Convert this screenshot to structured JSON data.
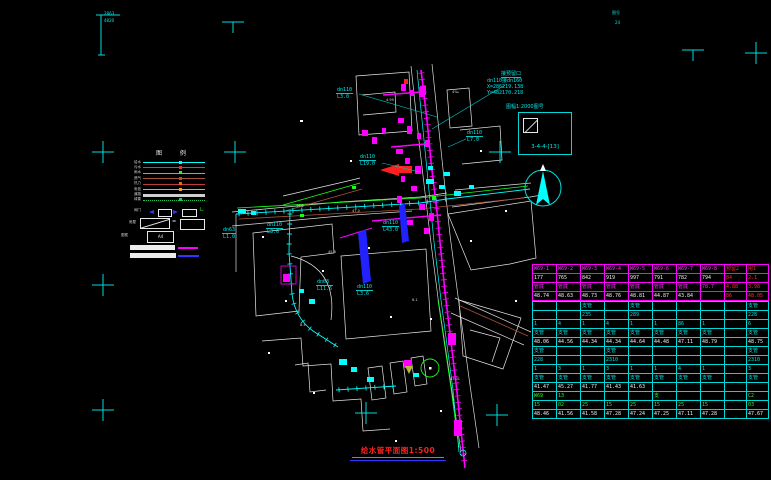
{
  "title": {
    "text": "给水管平面图1:500"
  },
  "corner": {
    "t1": "2863",
    "t2": "4820",
    "tr1": "图号",
    "tr2": "24"
  },
  "north_label": "北",
  "scale_box": {
    "title": "图幅1:2000图号",
    "code": "3-4-4-[13]"
  },
  "callout": {
    "l1": "接预留口",
    "l2": "dn110接dn160",
    "l3": "X=286219.138",
    "l4": "Y=482170.218"
  },
  "legend": {
    "header": "图 例",
    "lines": [
      {
        "label": "给水",
        "color": "#00ffff",
        "thick": 1.4,
        "marker": "#00ffff",
        "dotted": false
      },
      {
        "label": "污水",
        "color": "#ff2a2a",
        "thick": 1,
        "marker": "#ff2a2a",
        "dotted": false
      },
      {
        "label": "雨水",
        "color": "#19ff19",
        "thick": 1,
        "marker": "#19ff19",
        "dotted": false
      },
      {
        "label": "燃气",
        "color": "#a5533a",
        "thick": 1,
        "marker": "#a5533a",
        "dotted": false
      },
      {
        "label": "热力",
        "color": "#c03a3a",
        "thick": 1,
        "marker": "#ff6a00",
        "dotted": false
      },
      {
        "label": "电信",
        "color": "#ff9f1a",
        "thick": 1,
        "marker": "#ff9f1a",
        "dotted": false
      },
      {
        "label": "道路",
        "color": "#cfcfcf",
        "thick": 2.2,
        "marker": "",
        "dotted": false
      },
      {
        "label": "绿篱",
        "color": "#19cc55",
        "thick": 1,
        "marker": "#19cc55",
        "dotted": true
      }
    ],
    "symbols_label": "阀门",
    "boxes_label": "房屋",
    "eq": "=",
    "frame_label": "图框",
    "frame_text": "A4"
  },
  "reg_marks": {
    "crosses": [
      [
        103,
        152
      ],
      [
        235,
        152
      ],
      [
        500,
        152
      ],
      [
        103,
        285
      ],
      [
        103,
        410
      ],
      [
        366,
        413
      ],
      [
        497,
        415
      ],
      [
        756,
        53
      ]
    ],
    "tees": [
      [
        233,
        22
      ],
      [
        693,
        50
      ]
    ]
  },
  "pipe_labels": [
    {
      "t1": "dn110",
      "t2": "L3.0",
      "x": 336,
      "y": 87,
      "leader": [
        359,
        94,
        437,
        117
      ]
    },
    {
      "t1": "dn110",
      "t2": "L7.0",
      "x": 466,
      "y": 130,
      "leader": [
        466,
        139,
        448,
        147
      ]
    },
    {
      "t1": "dn110",
      "t2": "L19.0",
      "x": 359,
      "y": 154,
      "leader": [
        382,
        163,
        420,
        172
      ]
    },
    {
      "t1": "dn110",
      "t2": "L3.6",
      "x": 266,
      "y": 222,
      "leader": null
    },
    {
      "t1": "dn110",
      "t2": "L43.0",
      "x": 382,
      "y": 220,
      "leader": null
    },
    {
      "t1": "dn63",
      "t2": "L11.6",
      "x": 316,
      "y": 279,
      "leader": null
    },
    {
      "t1": "dn110",
      "t2": "L3.6",
      "x": 356,
      "y": 284,
      "leader": null
    },
    {
      "t1": "dn63",
      "t2": "L1.0",
      "x": 222,
      "y": 227,
      "leader": null
    }
  ],
  "map_texts": [
    {
      "t": "4‰",
      "x": 452,
      "y": 90
    },
    {
      "t": "4.99",
      "x": 386,
      "y": 98
    },
    {
      "t": "43.01",
      "x": 450,
      "y": 377
    },
    {
      "t": "46.2",
      "x": 296,
      "y": 204
    },
    {
      "t": "45.8",
      "x": 328,
      "y": 250
    },
    {
      "t": "47.0",
      "x": 352,
      "y": 209
    },
    {
      "t": "8.4",
      "x": 300,
      "y": 323
    },
    {
      "t": "6.1",
      "x": 412,
      "y": 298
    }
  ],
  "table": {
    "x": 532,
    "y": 264,
    "col_widths": [
      24,
      24,
      24,
      24,
      24,
      24,
      24,
      24,
      22,
      22
    ],
    "sections": [
      {
        "border": "#ff00ff",
        "rows": [
          {
            "cells": [
              [
                "W69-1",
                "m"
              ],
              [
                "W69-2",
                "m"
              ],
              [
                "W69-3",
                "m"
              ],
              [
                "W69-4",
                "m"
              ],
              [
                "W69-5",
                "m"
              ],
              [
                "W69-6",
                "m"
              ],
              [
                "W69-7",
                "m"
              ],
              [
                "W69-8",
                "m"
              ],
              [
                "预留2",
                "r"
              ],
              [
                "甩1",
                "r"
              ]
            ]
          },
          {
            "cells": [
              [
                "177",
                "w"
              ],
              [
                "765",
                "w"
              ],
              [
                "842",
                "w"
              ],
              [
                "919",
                "w"
              ],
              [
                "997",
                "w"
              ],
              [
                "791",
                "w"
              ],
              [
                "782",
                "w"
              ],
              [
                "794",
                "w"
              ],
              [
                "84",
                "r"
              ],
              [
                "2.1",
                "r"
              ]
            ]
          },
          {
            "cells": [
              [
                "管底",
                "m"
              ],
              [
                "管底",
                "m"
              ],
              [
                "管底",
                "m"
              ],
              [
                "管底",
                "m"
              ],
              [
                "管底",
                "m"
              ],
              [
                "管底",
                "m"
              ],
              [
                "管底",
                "m"
              ],
              [
                "78.7",
                "m"
              ],
              [
                "4.88",
                "r"
              ],
              [
                "3.98",
                "r"
              ]
            ]
          },
          {
            "cells": [
              [
                "48.74",
                "w"
              ],
              [
                "48.63",
                "w"
              ],
              [
                "48.73",
                "w"
              ],
              [
                "48.76",
                "w"
              ],
              [
                "48.81",
                "w"
              ],
              [
                "44.87",
                "w"
              ],
              [
                "43.84",
                "w"
              ],
              [
                "",
                "w"
              ],
              [
                "86",
                "r"
              ],
              [
                "48.05",
                "r"
              ]
            ]
          }
        ]
      },
      {
        "border": "#00d8d8",
        "rows": [
          {
            "cells": [
              [
                "",
                "c"
              ],
              [
                "",
                "c"
              ],
              [
                "支管",
                "c"
              ],
              [
                "",
                "c"
              ],
              [
                "支管",
                "c"
              ],
              [
                "",
                "c"
              ],
              [
                "",
                "c"
              ],
              [
                "",
                "c"
              ],
              [
                "",
                "c"
              ],
              [
                "支管",
                "c"
              ]
            ]
          },
          {
            "cells": [
              [
                "",
                "c"
              ],
              [
                "",
                "c"
              ],
              [
                "235",
                "c"
              ],
              [
                "",
                "c"
              ],
              [
                "289",
                "c"
              ],
              [
                "",
                "c"
              ],
              [
                "",
                "c"
              ],
              [
                "",
                "c"
              ],
              [
                "",
                "c"
              ],
              [
                "228",
                "c"
              ]
            ]
          },
          {
            "cells": [
              [
                "1",
                "c"
              ],
              [
                "4",
                "c"
              ],
              [
                "1",
                "c"
              ],
              [
                "4",
                "c"
              ],
              [
                "1",
                "c"
              ],
              [
                "1",
                "c"
              ],
              [
                "86",
                "c"
              ],
              [
                "1",
                "c"
              ],
              [
                "",
                "c"
              ],
              [
                "6",
                "c"
              ]
            ]
          },
          {
            "cells": [
              [
                "支管",
                "c"
              ],
              [
                "支管",
                "c"
              ],
              [
                "支管",
                "c"
              ],
              [
                "支管",
                "c"
              ],
              [
                "支管",
                "c"
              ],
              [
                "支管",
                "c"
              ],
              [
                "支管",
                "c"
              ],
              [
                "支管",
                "c"
              ],
              [
                "",
                "c"
              ],
              [
                "支管",
                "c"
              ]
            ]
          },
          {
            "cells": [
              [
                "48.06",
                "w"
              ],
              [
                "44.56",
                "w"
              ],
              [
                "44.34",
                "w"
              ],
              [
                "44.34",
                "w"
              ],
              [
                "44.64",
                "w"
              ],
              [
                "44.48",
                "w"
              ],
              [
                "47.11",
                "w"
              ],
              [
                "48.79",
                "w"
              ],
              [
                "",
                "w"
              ],
              [
                "48.75",
                "w"
              ]
            ]
          },
          {
            "cells": [
              [
                "支管",
                "c"
              ],
              [
                "",
                "c"
              ],
              [
                "",
                "c"
              ],
              [
                "支管",
                "c"
              ],
              [
                "",
                "c"
              ],
              [
                "",
                "c"
              ],
              [
                "",
                "c"
              ],
              [
                "",
                "c"
              ],
              [
                "",
                "c"
              ],
              [
                "支管",
                "c"
              ]
            ]
          },
          {
            "cells": [
              [
                "228",
                "c"
              ],
              [
                "",
                "c"
              ],
              [
                "",
                "c"
              ],
              [
                "2310",
                "c"
              ],
              [
                "",
                "c"
              ],
              [
                "",
                "c"
              ],
              [
                "",
                "c"
              ],
              [
                "",
                "c"
              ],
              [
                "",
                "c"
              ],
              [
                "2310",
                "c"
              ]
            ]
          },
          {
            "cells": [
              [
                "1",
                "c"
              ],
              [
                "3",
                "c"
              ],
              [
                "1",
                "c"
              ],
              [
                "3",
                "c"
              ],
              [
                "1",
                "c"
              ],
              [
                "1",
                "c"
              ],
              [
                "4",
                "c"
              ],
              [
                "1",
                "c"
              ],
              [
                "",
                "c"
              ],
              [
                "3",
                "c"
              ]
            ]
          },
          {
            "cells": [
              [
                "支管",
                "c"
              ],
              [
                "支管",
                "c"
              ],
              [
                "支管",
                "c"
              ],
              [
                "支管",
                "c"
              ],
              [
                "支管",
                "c"
              ],
              [
                "支管",
                "c"
              ],
              [
                "支管",
                "c"
              ],
              [
                "支管",
                "c"
              ],
              [
                "",
                "c"
              ],
              [
                "支管",
                "c"
              ]
            ]
          },
          {
            "cells": [
              [
                "41.47",
                "w"
              ],
              [
                "45.27",
                "w"
              ],
              [
                "41.77",
                "w"
              ],
              [
                "41.43",
                "w"
              ],
              [
                "41.63",
                "w"
              ],
              [
                "",
                "w"
              ],
              [
                "",
                "w"
              ],
              [
                "",
                "w"
              ],
              [
                "",
                "w"
              ],
              [
                "",
                "w"
              ]
            ]
          },
          {
            "cells": [
              [
                "W69",
                "g"
              ],
              [
                "13",
                "g"
              ],
              [
                "",
                "g"
              ],
              [
                "",
                "g"
              ],
              [
                "",
                "g"
              ],
              [
                "支",
                "g"
              ],
              [
                "",
                "g"
              ],
              [
                "",
                "g"
              ],
              [
                "",
                "g"
              ],
              [
                "C2",
                "g"
              ]
            ]
          },
          {
            "cells": [
              [
                "15",
                "g"
              ],
              [
                "02",
                "g"
              ],
              [
                "25",
                "g"
              ],
              [
                "15",
                "g"
              ],
              [
                "25",
                "g"
              ],
              [
                "15",
                "g"
              ],
              [
                "25",
                "g"
              ],
              [
                "15",
                "g"
              ],
              [
                "",
                "g"
              ],
              [
                "03",
                "g"
              ]
            ]
          },
          {
            "cells": [
              [
                "48.46",
                "w"
              ],
              [
                "41.56",
                "w"
              ],
              [
                "41.58",
                "w"
              ],
              [
                "47.28",
                "w"
              ],
              [
                "47.24",
                "w"
              ],
              [
                "47.25",
                "w"
              ],
              [
                "47.11",
                "w"
              ],
              [
                "47.28",
                "w"
              ],
              [
                "",
                "w"
              ],
              [
                "47.67",
                "w"
              ]
            ]
          }
        ]
      }
    ]
  }
}
